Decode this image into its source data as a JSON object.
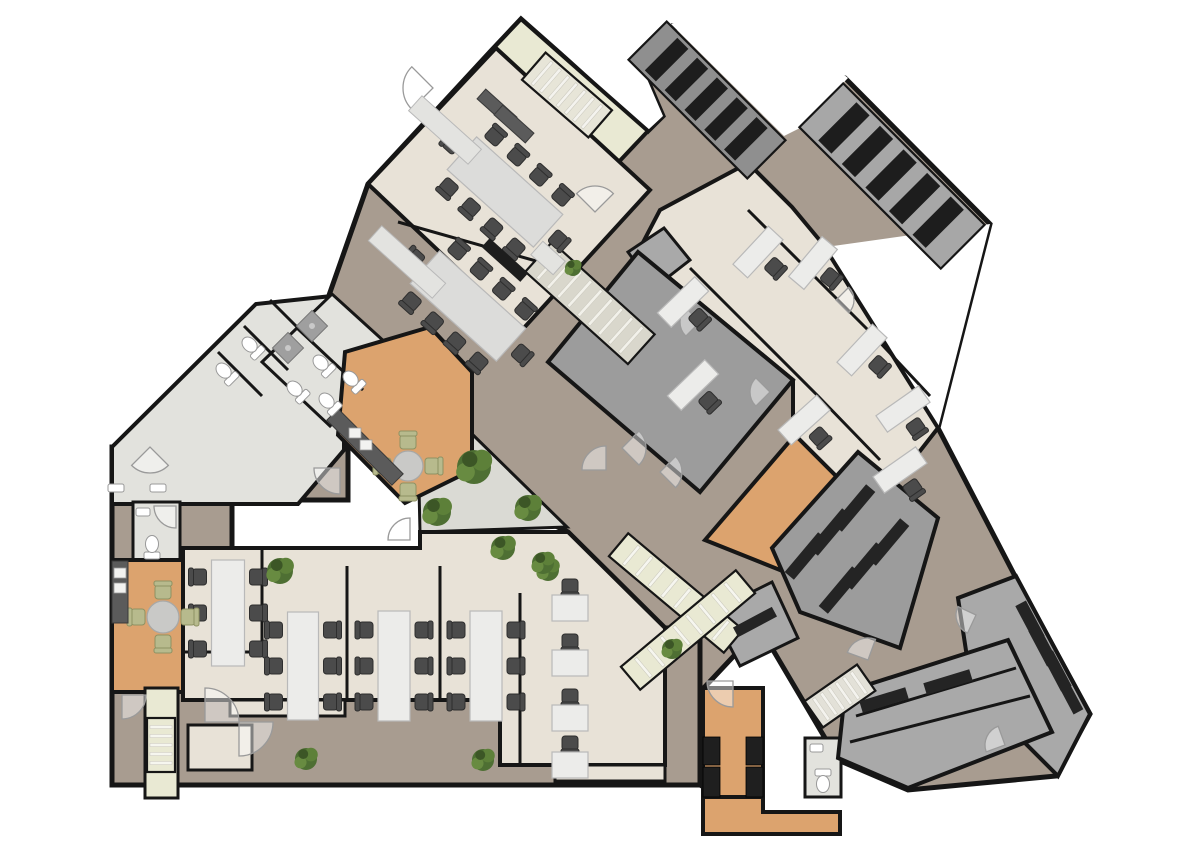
{
  "canvas": {
    "w": 1200,
    "h": 849,
    "bg": "#ffffff"
  },
  "palette": {
    "wall": "#161616",
    "plank": "#a89c90",
    "beige": "#e8e2d7",
    "tile": "#e2e2dd",
    "pale": "#e9e9d3",
    "hall": "#9c9c9c",
    "grayroom": "#a9a9a9",
    "graydark": "#8f8f8f",
    "wood": "#dca36e",
    "counter": "#5b5b5b",
    "dark": "#1d1d1d",
    "desk": "#ececea",
    "deskline": "#b9b9b9",
    "table": "#dcdcda",
    "chair": "#4b4b4b",
    "chairline": "#2e2e2e",
    "green1": "#4e6f33",
    "green2": "#5d8039",
    "green3": "#688b41",
    "green4": "#3c5626",
    "chairgreen": "#b7ba8d",
    "white": "#ffffff",
    "arc": "#9a9a9a",
    "courtyard": "#dadad4"
  },
  "regions": [
    {
      "name": "corridor-main",
      "fill": "plank",
      "sw": 5,
      "pts": "368,184 490,52 521,19 648,131 663,116 638,58 672,26 845,78 990,224 938,428 1016,578 1090,714 1056,776 908,790 838,760 760,628 700,692 700,785 665,765 665,628 568,532 414,458 300,378"
    },
    {
      "name": "corridor-southwest",
      "fill": "plank",
      "sw": 5,
      "pts": "112,447 348,447 348,500 232,500 232,660 665,660 665,628 700,628 700,785 112,785"
    },
    {
      "name": "void-notch-1",
      "fill": "white",
      "sw": 0,
      "pts": "525,18 648,130 663,116 638,58"
    },
    {
      "name": "void-notch-2",
      "fill": "white",
      "sw": 0,
      "pts": "671,24 784,136 800,128 848,78 770,16"
    },
    {
      "name": "void-notch-3",
      "fill": "white",
      "sw": 0,
      "pts": "826,247 938,428 990,224"
    },
    {
      "name": "stairwell-top",
      "fill": "pale",
      "sw": 4,
      "pts": "487,55 521,19 648,131 614,167"
    },
    {
      "name": "conference-block",
      "fill": "beige",
      "sw": 4,
      "pts": "368,184 496,48 650,190 522,330"
    },
    {
      "name": "office-wing",
      "fill": "beige",
      "sw": 4,
      "pts": "660,210 748,163 792,207 822,243 938,428 852,538 793,477 793,380 638,252"
    },
    {
      "name": "storage-mini",
      "fill": "grayroom",
      "sw": 3,
      "pts": "628,252 664,228 690,260 654,288"
    },
    {
      "name": "hall-dark",
      "fill": "hall",
      "sw": 4,
      "pts": "638,252 793,380 700,492 548,362"
    },
    {
      "name": "courtyard",
      "fill": "courtyard",
      "sw": 3,
      "pts": "470,432 567,527 420,532 419,488"
    },
    {
      "name": "entrance-wing",
      "fill": "tile",
      "sw": 4,
      "pts": "112,447 256,304 332,296 396,356 344,404 344,450 298,504 112,504"
    },
    {
      "name": "wet-rooms",
      "fill": "tile",
      "sw": 3,
      "pts": "262,362 332,294 398,354 330,426"
    },
    {
      "name": "kitchen-top",
      "fill": "wood",
      "sw": 4,
      "pts": "345,352 430,327 472,372 472,470 405,503 338,435"
    },
    {
      "name": "wc-left",
      "fill": "tile",
      "sw": 3,
      "pts": "133,502 180,502 180,560 133,560"
    },
    {
      "name": "kitchen-bottomleft",
      "fill": "wood",
      "sw": 4,
      "pts": "112,560 235,560 235,692 112,692"
    },
    {
      "name": "open-office",
      "fill": "beige",
      "sw": 4,
      "pts": "183,548 420,548 420,532 568,532 665,628 665,765 500,765 500,700 183,700"
    },
    {
      "name": "wall-tab-a",
      "fill": "beige",
      "sw": 3,
      "pts": "230,700 345,700 345,716 230,716"
    },
    {
      "name": "wall-tab-b",
      "fill": "beige",
      "sw": 3,
      "pts": "555,765 665,765 665,781 555,781"
    },
    {
      "name": "closet",
      "fill": "beige",
      "sw": 3,
      "pts": "188,725 252,725 252,770 188,770"
    },
    {
      "name": "stair-shaft-left",
      "fill": "pale",
      "sw": 3,
      "pts": "145,688 178,688 178,798 145,798"
    },
    {
      "name": "l-wood-corridor",
      "fill": "wood",
      "sw": 4,
      "pts": "705,540 795,435 865,505 800,578"
    },
    {
      "name": "bench-room",
      "fill": "hall",
      "sw": 4,
      "pts": "772,548 858,452 938,518 900,648 800,612"
    },
    {
      "name": "bench-room-small",
      "fill": "grayroom",
      "sw": 3,
      "pts": "712,612 772,582 798,638 740,666"
    },
    {
      "name": "bar-neck",
      "fill": "wood",
      "sw": 4,
      "pts": "703,688 763,688 763,797 703,797"
    },
    {
      "name": "bar-foot",
      "fill": "wood",
      "sw": 4,
      "pts": "703,797 763,797 763,812 840,812 840,834 703,834"
    },
    {
      "name": "wc-bar",
      "fill": "tile",
      "sw": 3,
      "pts": "805,738 841,738 841,797 805,797"
    },
    {
      "name": "far-right-wing",
      "fill": "grayroom",
      "sw": 4,
      "pts": "958,598 1016,576 1090,714 1058,776 972,690"
    },
    {
      "name": "bottom-right-rooms",
      "fill": "grayroom",
      "sw": 4,
      "pts": "845,692 1008,640 1052,732 908,788 838,758"
    }
  ],
  "inner_walls": [
    {
      "name": "conf-divider",
      "pts": "398,222 575,272"
    },
    {
      "name": "office-wall-1",
      "pts": "690,268 754,332"
    },
    {
      "name": "office-wall-2",
      "pts": "754,332 818,396"
    },
    {
      "name": "office-wall-3",
      "pts": "818,396 880,460"
    },
    {
      "name": "office-wall-4",
      "pts": "748,210 810,272"
    },
    {
      "name": "office-wall-5",
      "pts": "810,272 872,334"
    },
    {
      "name": "office-wall-6",
      "pts": "872,334 930,396"
    },
    {
      "name": "openoffice-part-1",
      "pts": "262,548 262,652"
    },
    {
      "name": "openoffice-part-2",
      "pts": "347,566 347,700"
    },
    {
      "name": "openoffice-part-3",
      "pts": "440,566 440,700"
    },
    {
      "name": "openoffice-part-4",
      "pts": "520,593 520,765"
    },
    {
      "name": "openoffice-closet-wall",
      "pts": "183,652 262,652"
    },
    {
      "name": "brr-wall-1",
      "pts": "856,716 1016,668"
    },
    {
      "name": "brr-wall-2",
      "pts": "850,742 1030,696"
    },
    {
      "name": "stall-wall-1",
      "pts": "218,352 262,396"
    },
    {
      "name": "stall-wall-2",
      "pts": "244,326 288,370"
    },
    {
      "name": "stall-wall-3",
      "pts": "270,300 314,344"
    },
    {
      "name": "wetroom-wall",
      "pts": "297,328 363,390"
    }
  ],
  "stairs": [
    {
      "name": "stairs-top-stairwell",
      "cx": 567,
      "cy": 95,
      "rot": 41,
      "len": 88,
      "wid": 36,
      "steps": 7,
      "base": "#e7e5d8",
      "tread": "#f4f3ee",
      "kind": "line"
    },
    {
      "name": "stairs-bank-ne-1",
      "cx": 707,
      "cy": 100,
      "rot": 45,
      "len": 168,
      "wid": 54,
      "steps": 5,
      "base": "#8f8f8f",
      "tread": "#1d1d1d",
      "kind": "bar"
    },
    {
      "name": "stairs-bank-ne-2",
      "cx": 892,
      "cy": 176,
      "rot": 45,
      "len": 200,
      "wid": 62,
      "steps": 5,
      "base": "#a7a7a7",
      "tread": "#1d1d1d",
      "kind": "bar"
    },
    {
      "name": "stairs-hall",
      "cx": 590,
      "cy": 303,
      "rot": 42,
      "len": 138,
      "wid": 40,
      "steps": 9,
      "base": "#d9d7cc",
      "tread": "#f2f1ea",
      "kind": "line"
    },
    {
      "name": "escalator-1",
      "cx": 676,
      "cy": 593,
      "rot": 40,
      "len": 150,
      "wid": 30,
      "steps": 8,
      "base": "#e9e9d3",
      "tread": "#f6f6ef",
      "kind": "line"
    },
    {
      "name": "escalator-2",
      "cx": 688,
      "cy": 630,
      "rot": -40,
      "len": 150,
      "wid": 30,
      "steps": 8,
      "base": "#e9e9d3",
      "tread": "#f6f6ef",
      "kind": "line"
    },
    {
      "name": "stairs-bottom-right",
      "cx": 840,
      "cy": 696,
      "rot": -35,
      "len": 64,
      "wid": 32,
      "steps": 6,
      "base": "#e3e1d8",
      "tread": "#f4f3ee",
      "kind": "line"
    },
    {
      "name": "stairs-shaft-left",
      "cx": 161,
      "cy": 745,
      "rot": 90,
      "len": 54,
      "wid": 28,
      "steps": 5,
      "base": "#e9e9d3",
      "tread": "#f6f6ef",
      "kind": "line"
    }
  ],
  "conference_tables": [
    {
      "name": "conference-table-1",
      "cx": 505,
      "cy": 192,
      "w": 116,
      "h": 44,
      "rot": 42
    },
    {
      "name": "conference-table-2",
      "cx": 468,
      "cy": 306,
      "w": 116,
      "h": 44,
      "rot": 42
    }
  ],
  "long_tables": [
    {
      "name": "bench-desk-1",
      "cx": 228,
      "cy": 613,
      "w": 33,
      "h": 106
    },
    {
      "name": "bench-desk-2",
      "cx": 303,
      "cy": 666,
      "w": 31,
      "h": 108
    },
    {
      "name": "bench-desk-3",
      "cx": 394,
      "cy": 666,
      "w": 32,
      "h": 110
    },
    {
      "name": "bench-desk-4",
      "cx": 486,
      "cy": 666,
      "w": 32,
      "h": 110
    }
  ],
  "small_desks": [
    {
      "cx": 570,
      "cy": 608
    },
    {
      "cx": 570,
      "cy": 663
    },
    {
      "cx": 570,
      "cy": 718
    },
    {
      "cx": 570,
      "cy": 765
    }
  ],
  "office_desks": [
    {
      "cx": 683,
      "cy": 302,
      "rot": -44
    },
    {
      "cx": 758,
      "cy": 252,
      "rot": -47
    },
    {
      "cx": 813,
      "cy": 263,
      "rot": -50
    },
    {
      "cx": 693,
      "cy": 385,
      "rot": -44
    },
    {
      "cx": 804,
      "cy": 420,
      "rot": -42
    },
    {
      "cx": 903,
      "cy": 409,
      "rot": -35
    },
    {
      "cx": 862,
      "cy": 350,
      "rot": -47
    },
    {
      "cx": 900,
      "cy": 470,
      "rot": -35
    }
  ],
  "round_tables": [
    {
      "name": "kitchen-table-top",
      "cx": 408,
      "cy": 466,
      "r": 15,
      "chairs": 4
    },
    {
      "name": "kitchen-table-left",
      "cx": 163,
      "cy": 617,
      "r": 16,
      "chairs": 4
    }
  ],
  "counters": [
    {
      "name": "kitchen-counter-top",
      "cx": 365,
      "cy": 447,
      "w": 92,
      "h": 16,
      "rot": 45
    },
    {
      "name": "kitchen-counter-left",
      "cx": 120,
      "cy": 592,
      "w": 16,
      "h": 62,
      "rot": 0
    },
    {
      "name": "conf-kitchenette-1",
      "cx": 497,
      "cy": 108,
      "w": 42,
      "h": 13,
      "rot": 42
    },
    {
      "name": "conf-kitchenette-2",
      "cx": 514,
      "cy": 124,
      "w": 42,
      "h": 13,
      "rot": 42
    }
  ],
  "credenzas": [
    {
      "cx": 445,
      "cy": 130,
      "w": 80,
      "h": 20,
      "rot": 42
    },
    {
      "cx": 407,
      "cy": 262,
      "w": 86,
      "h": 20,
      "rot": 42
    },
    {
      "cx": 548,
      "cy": 258,
      "w": 30,
      "h": 18,
      "rot": 42
    }
  ],
  "tv_units": [
    {
      "cx": 505,
      "cy": 260,
      "w": 52,
      "h": 12,
      "rot": 42
    }
  ],
  "benches": [
    {
      "cx": 806,
      "cy": 556,
      "w": 52,
      "h": 12,
      "rot": -50
    },
    {
      "cx": 830,
      "cy": 532,
      "w": 52,
      "h": 12,
      "rot": -50
    },
    {
      "cx": 854,
      "cy": 508,
      "w": 52,
      "h": 12,
      "rot": -50
    },
    {
      "cx": 840,
      "cy": 590,
      "w": 52,
      "h": 12,
      "rot": -50
    },
    {
      "cx": 864,
      "cy": 566,
      "w": 52,
      "h": 12,
      "rot": -50
    },
    {
      "cx": 888,
      "cy": 542,
      "w": 52,
      "h": 12,
      "rot": -50
    },
    {
      "cx": 755,
      "cy": 622,
      "w": 44,
      "h": 11,
      "rot": -28
    },
    {
      "cx": 884,
      "cy": 700,
      "w": 48,
      "h": 12,
      "rot": -17
    },
    {
      "cx": 948,
      "cy": 682,
      "w": 48,
      "h": 12,
      "rot": -17
    },
    {
      "cx": 1030,
      "cy": 621,
      "w": 40,
      "h": 12,
      "rot": 62
    },
    {
      "cx": 1043,
      "cy": 646,
      "w": 40,
      "h": 12,
      "rot": 62
    },
    {
      "cx": 1057,
      "cy": 671,
      "w": 40,
      "h": 12,
      "rot": 62
    },
    {
      "cx": 1070,
      "cy": 696,
      "w": 36,
      "h": 11,
      "rot": 62
    }
  ],
  "bar_cabinets": [
    {
      "x": 703,
      "y": 737,
      "w": 17,
      "h": 28
    },
    {
      "x": 703,
      "y": 767,
      "w": 17,
      "h": 30
    },
    {
      "x": 746,
      "y": 737,
      "w": 17,
      "h": 28
    },
    {
      "x": 746,
      "y": 767,
      "w": 17,
      "h": 30
    }
  ],
  "appliances": [
    {
      "x": 349,
      "y": 428,
      "w": 12,
      "h": 10
    },
    {
      "x": 360,
      "y": 440,
      "w": 12,
      "h": 10
    },
    {
      "x": 114,
      "y": 568,
      "w": 12,
      "h": 10
    },
    {
      "x": 114,
      "y": 583,
      "w": 12,
      "h": 10
    }
  ],
  "plants": [
    {
      "cx": 474,
      "cy": 467,
      "r": 17
    },
    {
      "cx": 437,
      "cy": 512,
      "r": 14
    },
    {
      "cx": 528,
      "cy": 508,
      "r": 13
    },
    {
      "cx": 503,
      "cy": 548,
      "r": 12
    },
    {
      "cx": 548,
      "cy": 570,
      "r": 11
    },
    {
      "cx": 280,
      "cy": 571,
      "r": 13
    },
    {
      "cx": 306,
      "cy": 759,
      "r": 11
    },
    {
      "cx": 483,
      "cy": 760,
      "r": 11
    },
    {
      "cx": 543,
      "cy": 563,
      "r": 11
    },
    {
      "cx": 672,
      "cy": 649,
      "r": 10
    },
    {
      "cx": 573,
      "cy": 268,
      "r": 8
    }
  ],
  "toilets": [
    {
      "cx": 225,
      "cy": 372,
      "rot": 135
    },
    {
      "cx": 251,
      "cy": 346,
      "rot": 135
    },
    {
      "cx": 296,
      "cy": 390,
      "rot": 135
    },
    {
      "cx": 322,
      "cy": 364,
      "rot": 135
    },
    {
      "cx": 352,
      "cy": 380,
      "rot": 135
    },
    {
      "cx": 328,
      "cy": 402,
      "rot": 135
    },
    {
      "cx": 152,
      "cy": 546,
      "rot": 180
    },
    {
      "cx": 823,
      "cy": 782,
      "rot": 0
    }
  ],
  "showers": [
    {
      "cx": 288,
      "cy": 348,
      "rot": 45
    },
    {
      "cx": 312,
      "cy": 326,
      "rot": 45
    }
  ],
  "sinks": [
    {
      "x": 108,
      "y": 484,
      "w": 16,
      "h": 8
    },
    {
      "x": 150,
      "y": 484,
      "w": 16,
      "h": 8
    },
    {
      "x": 136,
      "y": 508,
      "w": 14,
      "h": 8
    },
    {
      "x": 810,
      "y": 744,
      "w": 13,
      "h": 8
    }
  ],
  "door_arcs": [
    {
      "x": 433,
      "y": 88,
      "r": 30,
      "rot": 135
    },
    {
      "x": 595,
      "y": 212,
      "r": 26,
      "rot": 225
    },
    {
      "x": 622,
      "y": 448,
      "r": 24,
      "rot": -45
    },
    {
      "x": 660,
      "y": 472,
      "r": 22,
      "rot": 315
    },
    {
      "x": 340,
      "y": 468,
      "r": 26,
      "rot": 90
    },
    {
      "x": 606,
      "y": 470,
      "r": 24,
      "rot": 180
    },
    {
      "x": 122,
      "y": 695,
      "r": 24,
      "rot": 0
    },
    {
      "x": 733,
      "y": 681,
      "r": 26,
      "rot": 90
    },
    {
      "x": 976,
      "y": 615,
      "r": 20,
      "rot": 115
    },
    {
      "x": 868,
      "y": 660,
      "r": 22,
      "rot": 200
    },
    {
      "x": 176,
      "y": 506,
      "r": 22,
      "rot": 90
    },
    {
      "x": 700,
      "y": 322,
      "r": 20,
      "rot": 135
    },
    {
      "x": 770,
      "y": 392,
      "r": 20,
      "rot": 135
    },
    {
      "x": 836,
      "y": 300,
      "r": 18,
      "rot": -45
    },
    {
      "x": 410,
      "y": 540,
      "r": 22,
      "rot": 180
    },
    {
      "x": 150,
      "y": 447,
      "r": 26,
      "rot": 45
    },
    {
      "x": 205,
      "y": 722,
      "r": 34,
      "rot": 270
    },
    {
      "x": 239,
      "y": 722,
      "r": 34,
      "rot": 0
    },
    {
      "x": 1005,
      "y": 745,
      "r": 20,
      "rot": 160
    }
  ]
}
